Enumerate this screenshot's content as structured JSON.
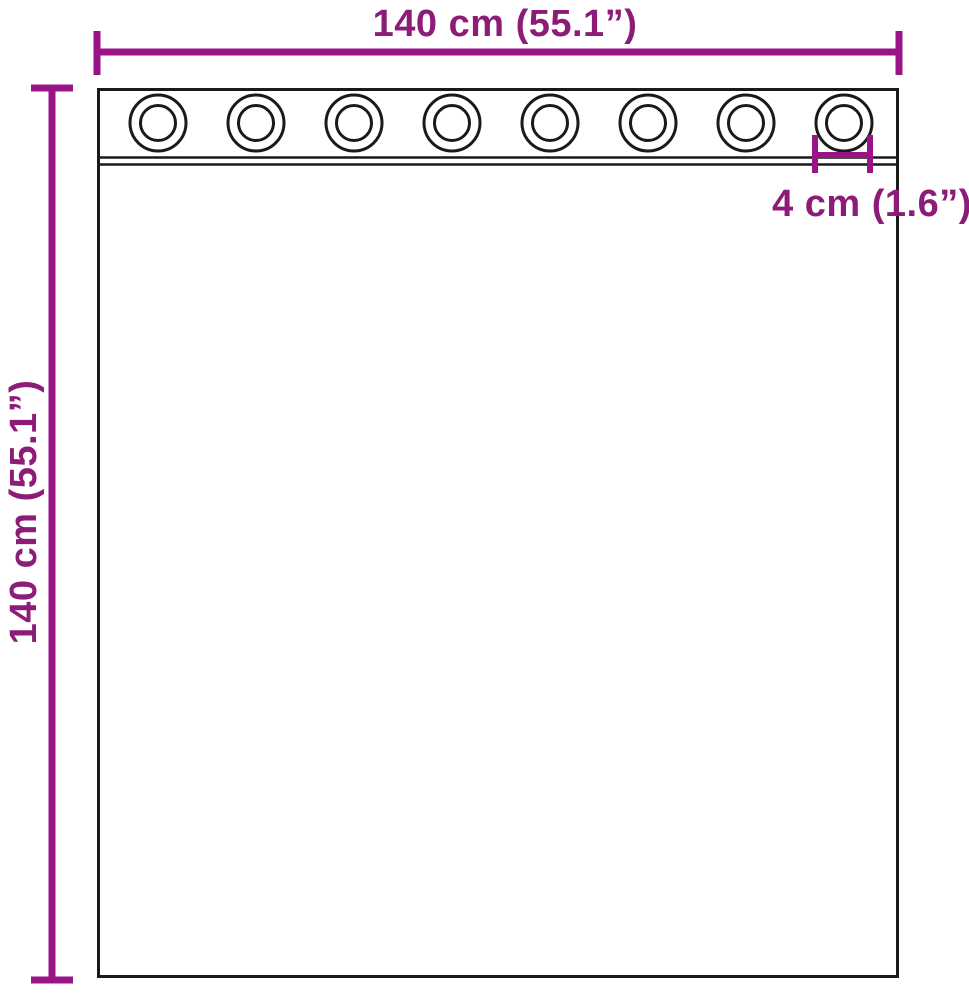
{
  "diagram": {
    "title": "curtain-with-grommets-dimension-diagram",
    "width_label": "140 cm (55.1”)",
    "height_label": "140 cm (55.1”)",
    "grommet_label": "4 cm (1.6”)",
    "grommet_count": 8,
    "colors": {
      "dimension_line": "#9b1487",
      "label_text": "#8c1c77",
      "outline": "#1a1a1a",
      "background": "#ffffff"
    }
  }
}
